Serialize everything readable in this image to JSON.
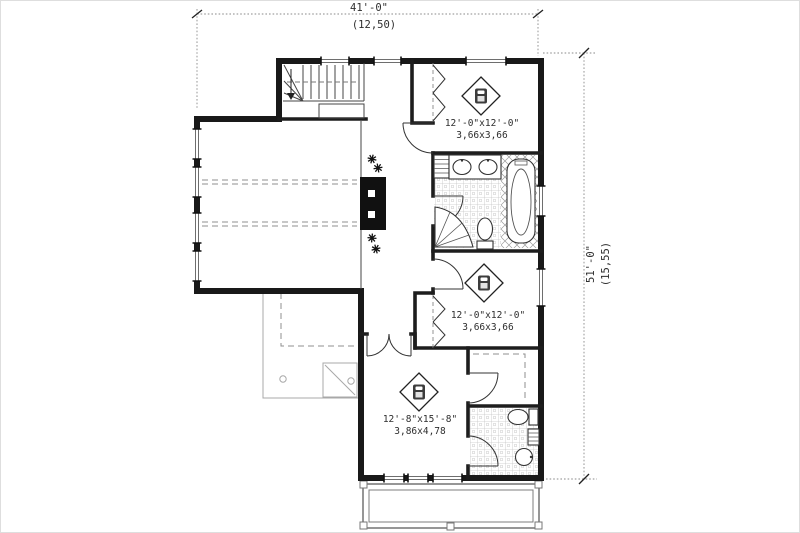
{
  "plan": {
    "type": "second-floor-plan",
    "dimensions": {
      "width_imperial": "41'-0\"",
      "width_metric": "(12,50)",
      "height_imperial": "51'-0\"",
      "height_metric": "(15,55)"
    },
    "rooms": {
      "bedroom_top": {
        "marker_icon": "bed-icon",
        "size_imperial": "12'-0\"x12'-0\"",
        "size_metric": "3,66x3,66"
      },
      "bedroom_middle": {
        "marker_icon": "bed-icon",
        "size_imperial": "12'-0\"x12'-0\"",
        "size_metric": "3,66x3,66"
      },
      "bedroom_master": {
        "marker_icon": "bed-icon",
        "size_imperial": "12'-8\"x15'-8\"",
        "size_metric": "3,86x4,78"
      }
    },
    "colors": {
      "wall": "#191919",
      "dim_line": "#8a8a8a",
      "text": "#2e2e2e",
      "background": "#ffffff"
    }
  }
}
